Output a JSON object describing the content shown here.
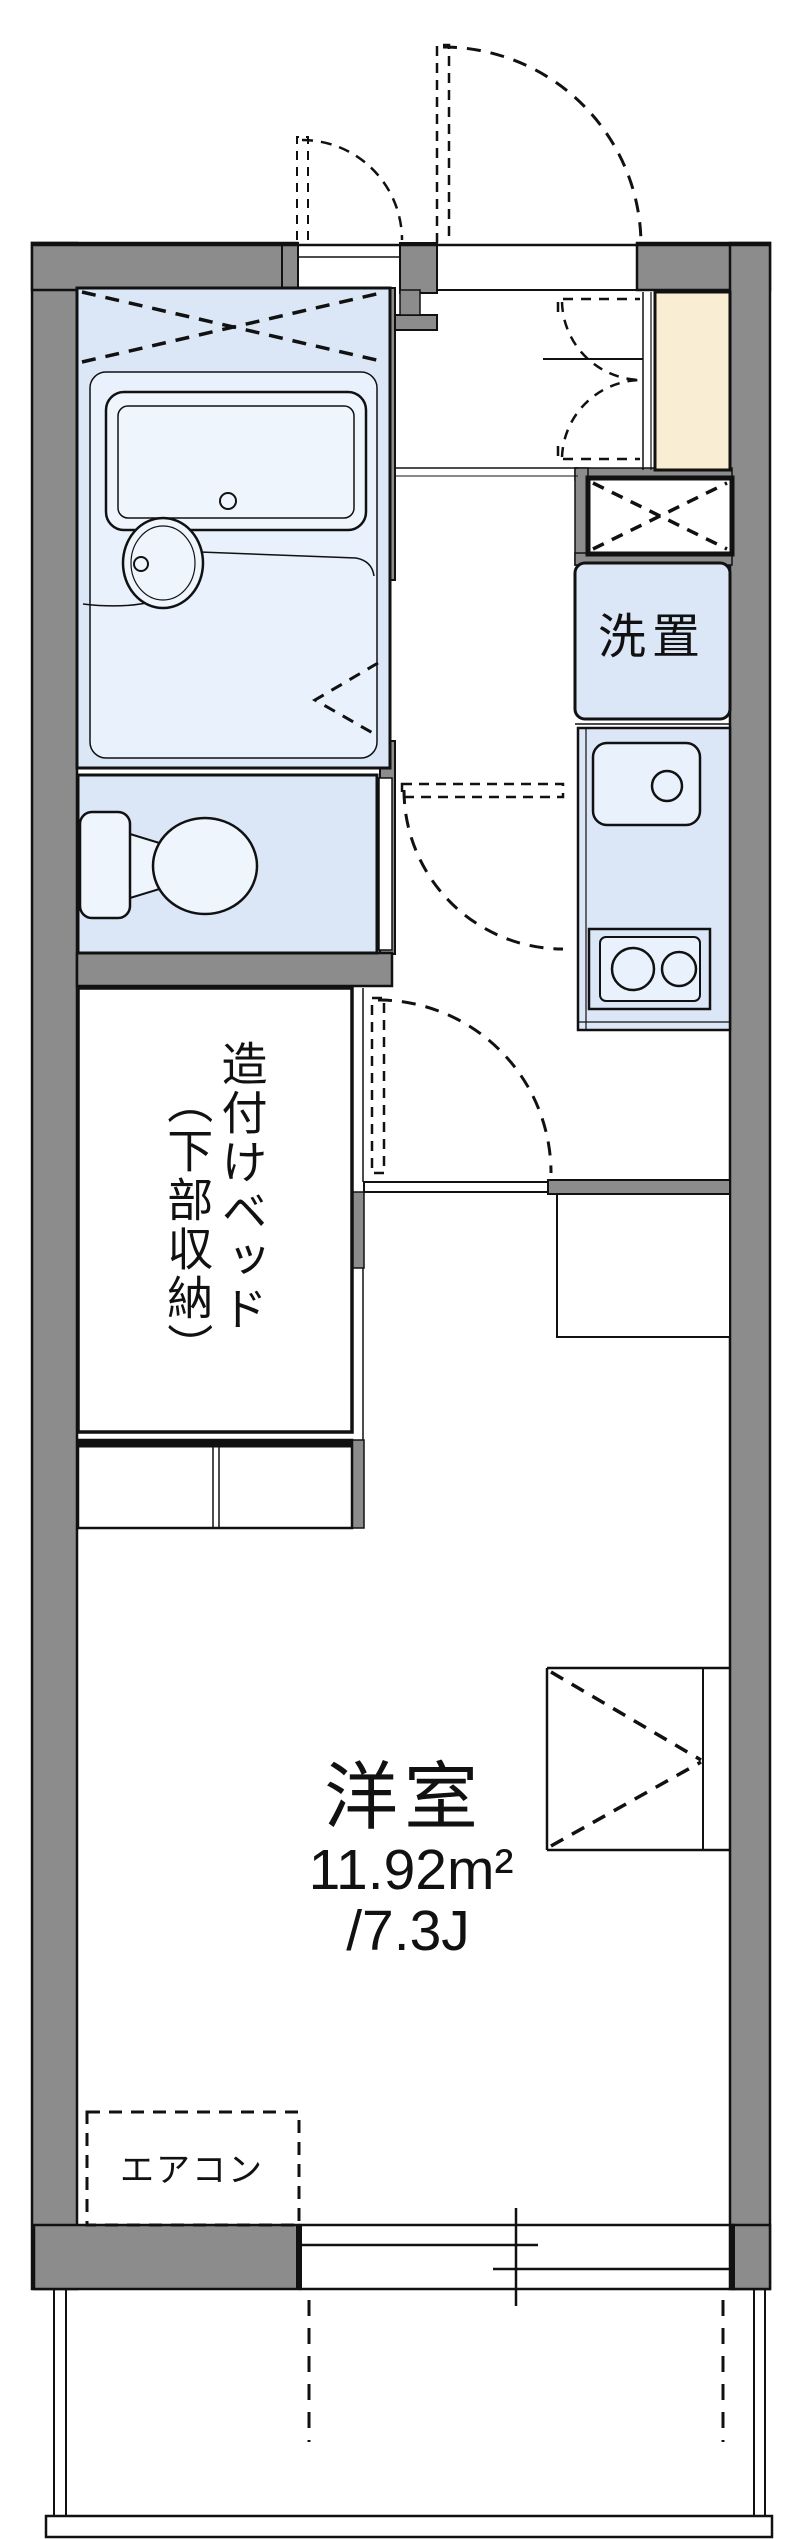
{
  "floorplan": {
    "title": "one-room apartment floor plan",
    "labels": {
      "laundry": "洗置",
      "built_in_bed_line1": "造付けベッド",
      "built_in_bed_line2": "（下部収納）",
      "room_name": "洋室",
      "room_area_m2": "11.92m²",
      "room_area_jo": "/7.3J",
      "aircon": "エアコン"
    },
    "rooms": [
      {
        "name": "洋室",
        "area_m2": 11.92,
        "area_tatami": "7.3J"
      },
      {
        "name": "unit-bath"
      },
      {
        "name": "toilet"
      },
      {
        "name": "kitchen"
      },
      {
        "name": "entrance"
      },
      {
        "name": "balcony"
      }
    ],
    "fixtures": [
      "bathtub",
      "washbasin",
      "toilet",
      "kitchen-sink",
      "two-burner-stove",
      "washing-machine-space",
      "shoe-cabinet",
      "built-in-bed",
      "under-bed-storage-shelf",
      "closet",
      "air-conditioner",
      "sliding-window",
      "entrance-door",
      "meter-box-door"
    ],
    "colors": {
      "wall_gray": "#8c8c8c",
      "fixture_blue": "#dbe7f7",
      "fixture_blue_light": "#e9f1fc",
      "fixture_blue_pale": "#eef5fd",
      "cabinet_cream": "#f9edd3",
      "line_black": "#111111"
    }
  }
}
